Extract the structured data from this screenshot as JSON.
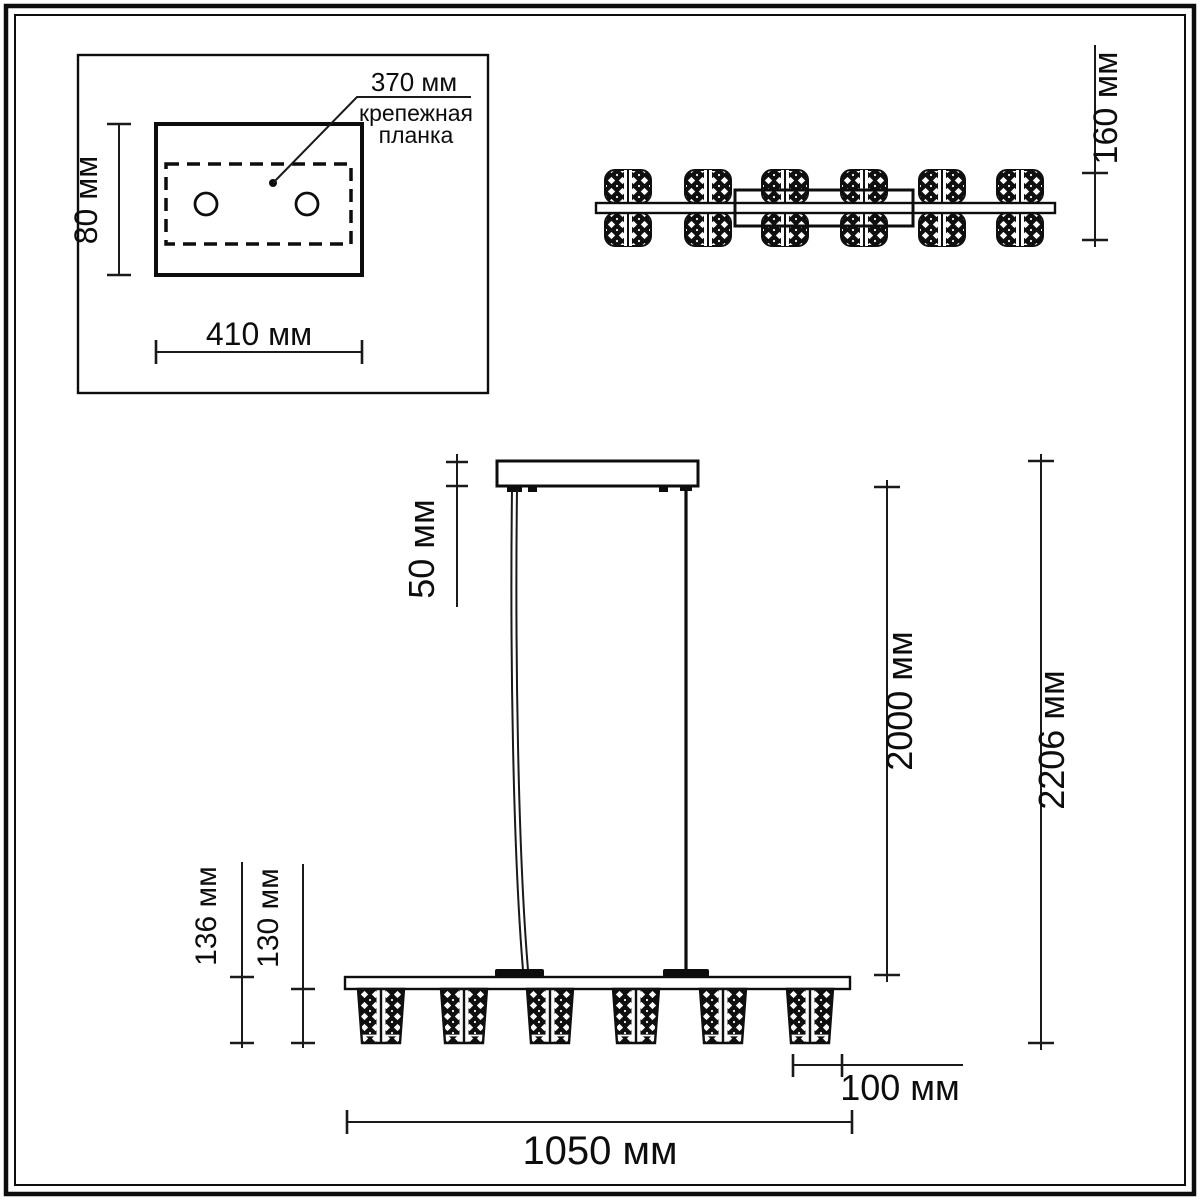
{
  "colors": {
    "line": "#0d0d0d",
    "background": "#ffffff"
  },
  "mounting_plate_view": {
    "plate_width_label": "370 мм",
    "plate_name_line1": "крепежная",
    "plate_name_line2": "планка",
    "height_label": "80 мм",
    "width_label": "410 мм"
  },
  "top_view": {
    "depth_label": "160 мм"
  },
  "front_view": {
    "canopy_height_label": "50 мм",
    "suspension_length_label": "2000 мм",
    "total_height_label": "2206 мм",
    "bar_with_shade_label": "136 мм",
    "shade_height_label": "130 мм",
    "shade_width_label": "100 мм",
    "bar_length_label": "1050 мм"
  }
}
